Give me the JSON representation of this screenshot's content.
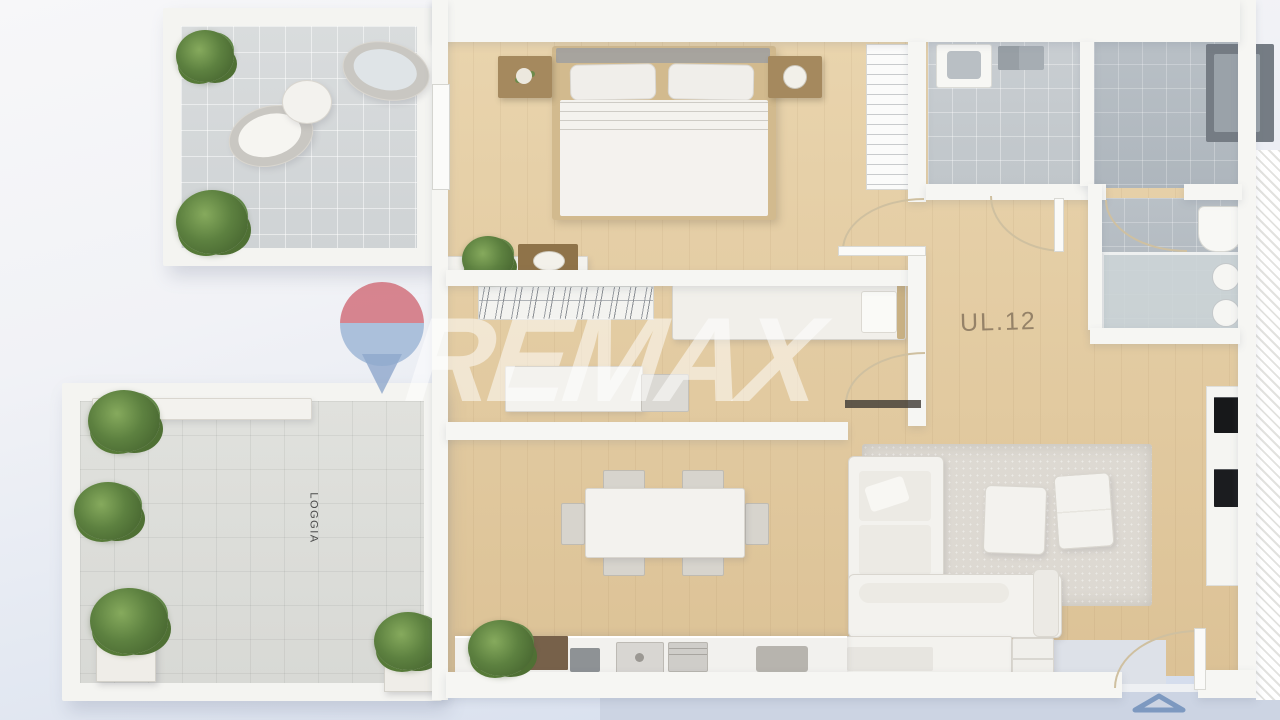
{
  "scene": {
    "type": "3D apartment floor plan render",
    "unit_label": "UL.12",
    "loggia_label": "LOGGIA"
  },
  "watermark": {
    "brand": "REMAX",
    "balloon_icon": "remax-balloon-icon",
    "balloon_top_color": "#ce606c",
    "balloon_bottom_color": "#92aed1",
    "text_color": "#ffffff"
  },
  "markers": {
    "entrance_arrow_icon": "entrance-direction-arrow",
    "entrance_arrow_color": "#7d99c0"
  },
  "palette": {
    "wood_floor": "#e0c79e",
    "terrace_tile": "#d6d9da",
    "loggia_tile": "#dcddd9",
    "bathroom_tile_light": "#c6cbcf",
    "bathroom_tile_dark": "#b4bbc1",
    "wall": "#f6f6f3",
    "rug": "#ddd9d2",
    "background_bottom": "#d2dbec"
  },
  "rooms": [
    {
      "name": "top-terrace",
      "floor": "light-gray-tile",
      "furniture": [
        "potted-plant",
        "potted-plant",
        "round-lounge-chair",
        "round-lounge-chair",
        "round-side-table"
      ]
    },
    {
      "name": "bedroom",
      "floor": "wood",
      "furniture": [
        "double-bed",
        "nightstand-left",
        "nightstand-right",
        "console-with-plant",
        "closet-shelves"
      ]
    },
    {
      "name": "bathroom",
      "floor": "gray-tile",
      "furniture": [
        "washbasin",
        "toilet-cistern"
      ]
    },
    {
      "name": "shower-room",
      "floor": "dark-gray-tile",
      "furniture": [
        "shower-enclosure",
        "toilet",
        "double-washbasin-vanity"
      ]
    },
    {
      "name": "hallway-room",
      "floor": "wood",
      "furniture": [
        "wardrobe-with-hangers",
        "single-bed",
        "sideboard",
        "door-mat"
      ]
    },
    {
      "name": "living-dining-kitchen",
      "floor": "wood",
      "furniture": [
        "corner-sofa",
        "area-rug",
        "pouf",
        "pouf",
        "tv-sideboard",
        "dining-table",
        "dining-chairs",
        "kitchen-counter",
        "kitchen-sink",
        "cooktop",
        "tall-appliance-column"
      ]
    },
    {
      "name": "loggia",
      "floor": "white-tile",
      "furniture": [
        "potted-plant",
        "potted-plant",
        "potted-plant",
        "potted-plant",
        "bench"
      ]
    }
  ]
}
